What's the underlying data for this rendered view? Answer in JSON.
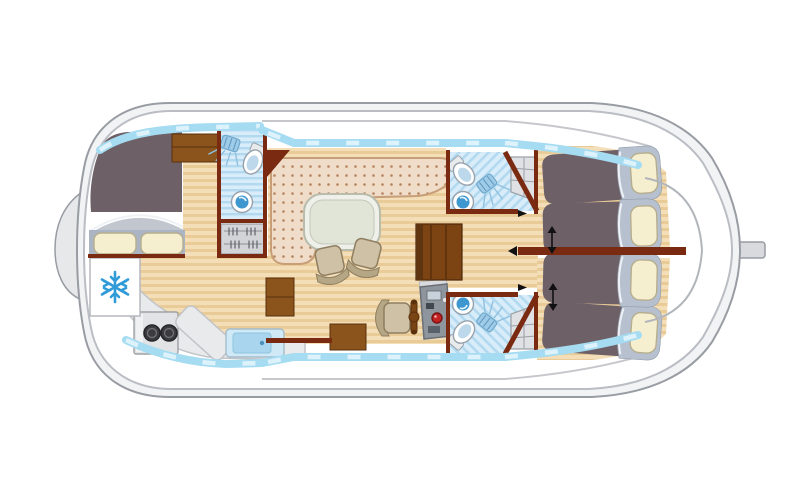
{
  "meta": {
    "title": "Canal boat deck plan",
    "description": "Top-down floor plan of a canal cruiser: bow double cabin, forward bathroom, galley, saloon with helm station, aft corridor with two bathrooms and two twin cabins, stern rudder"
  },
  "colors": {
    "hull_stroke": "#989ca3",
    "hull_fill": "#f2f3f5",
    "deck": "#ffffff",
    "inner_stroke": "#babdc3",
    "wall": "#7b2a12",
    "wood_base": "#f3deb8",
    "wood_stripe": "#e9cb98",
    "window": "#a5dcf2",
    "window_pane": "#ddf2fb",
    "sofa_base": "#efdcc9",
    "sofa_dot": "#b5835e",
    "sofa_stroke": "#c79e78",
    "table_outer": "#eef0e9",
    "table_inner": "#e1e5d8",
    "chair": "#cfc1a6",
    "chair_dark": "#b5a685",
    "chair_stroke": "#8f7f60",
    "blanket": "#6e6067",
    "bed_head": "#b6c0ce",
    "pillow": "#f6efcf",
    "pillow_stroke": "#b6ae8e",
    "platform": "#aab4c2",
    "fold": "#c2c7cf",
    "bath_base": "#d8edf9",
    "bath_stripe": "#b2d9ef",
    "fixture_white": "#ffffff",
    "fixture_stroke": "#98a2ac",
    "fixture_blue": "#bcd8ea",
    "basin_blue": "#3f97d0",
    "furniture_brown": "#8a541c",
    "furniture_dark": "#5a300c",
    "steps_brown": "#7c4413",
    "counter": "#e9eaec",
    "counter_stroke": "#c2c4c8",
    "burner": "#3c3c40",
    "sink_outer": "#cfe9f6",
    "sink_inner": "#a9d6ee",
    "console": "#8f959d",
    "console_dark": "#6b7077",
    "console_red": "#c32222",
    "snowflake": "#2f9bd8",
    "shelf": "#dfe1e4",
    "arrow": "#111111",
    "roofline": "#c5c7cb",
    "gray_line": "#b2b6bb"
  },
  "icons": {
    "snowflake_icon": "❄",
    "bed_slide_arrow": "↕"
  },
  "rooms": [
    {
      "id": "bow-cabin",
      "label": "Bow double-bed cabin"
    },
    {
      "id": "forward-bathroom",
      "label": "Forward bathroom (shower, WC, basin)"
    },
    {
      "id": "wardrobe",
      "label": "Wardrobe"
    },
    {
      "id": "galley",
      "label": "Galley (fridge, stove, sink)"
    },
    {
      "id": "saloon",
      "label": "Saloon with L-sofa and dining table"
    },
    {
      "id": "helm-station",
      "label": "Inside steering position"
    },
    {
      "id": "aft-corridor",
      "label": "Aft corridor with companionway steps"
    },
    {
      "id": "aft-bathroom-top",
      "label": "Aft bathroom 1 (shower, WC, basin)"
    },
    {
      "id": "aft-bathroom-bottom",
      "label": "Aft bathroom 2 (shower, WC, basin)"
    },
    {
      "id": "aft-cabin-top",
      "label": "Aft twin cabin 1 (sliding beds)"
    },
    {
      "id": "aft-cabin-bottom",
      "label": "Aft twin cabin 2 (sliding beds)"
    }
  ],
  "fixtures": [
    "double-bed",
    "refrigerator",
    "two-burner-stove",
    "galley-sink",
    "l-shaped-sofa",
    "dining-table",
    "dining-chair",
    "dining-chair",
    "helm-seat",
    "steering-wheel",
    "control-console",
    "companionway-steps",
    "toilet",
    "shower",
    "washbasin",
    "single-bed",
    "single-bed",
    "single-bed",
    "single-bed",
    "bed-slide-arrow",
    "bed-slide-arrow",
    "rudder",
    "bow-fender"
  ]
}
